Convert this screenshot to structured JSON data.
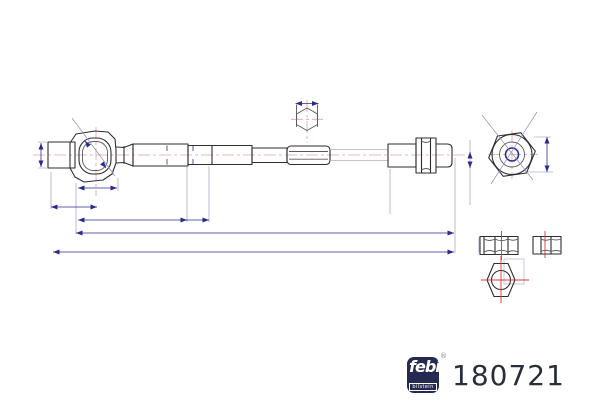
{
  "part": {
    "number": "180721"
  },
  "brand": {
    "name": "febi",
    "sub": "bilstein",
    "registered": "®"
  },
  "drawing": {
    "type": "technical-line-drawing",
    "subject": "inner tie rod / axial joint with lock nut",
    "views": [
      "main-side-view",
      "hex-section-detail",
      "end-view-hex",
      "nut-side-view-1",
      "nut-side-view-2",
      "nut-front-view"
    ],
    "dimension_labels_visible": false
  },
  "colors": {
    "outline": "#2e2e2e",
    "outline_light": "#5a5a5a",
    "thin_line": "#b3b3b3",
    "centerline": "#cc3b3b",
    "centerline_faint": "#dba4a4",
    "dimension": "#2b2b8f",
    "dimension_faint": "#8d8dc0",
    "detail_faint": "#b8bedd",
    "logo_bg": "#252a52",
    "part_number_text": "#2a2e3a"
  }
}
